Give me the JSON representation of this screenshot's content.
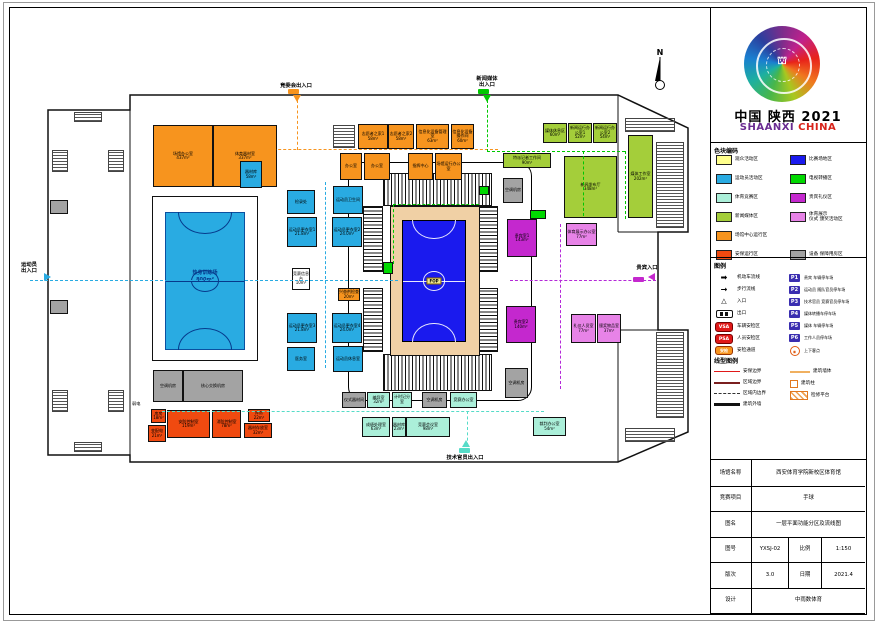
{
  "logo": {
    "cn": "中国 陕西 2021",
    "en1": "SHAANXI",
    "en2": "CHINA"
  },
  "north_label": "N",
  "palette": {
    "op": "#F7941E",
    "sec": "#F04A10",
    "ath": "#29ABE2",
    "comp": "#ABEFD9",
    "media": "#A4CE3A",
    "tv": "#00D800",
    "vip": "#C428CE",
    "cer": "#E783E7",
    "equip": "#A3A3A3",
    "fop": "#1A1AEE",
    "apron": "#F0D0A5",
    "white": "#FFFFFF"
  },
  "color_legend": {
    "title": "色块编码",
    "left": [
      {
        "label": "观众活动区",
        "color": "#FFFF8C"
      },
      {
        "label": "运动员活动区",
        "color": "#29ABE2"
      },
      {
        "label": "体育竞赛区",
        "color": "#ABEFD9"
      },
      {
        "label": "新闻媒体区",
        "color": "#A4CE3A"
      },
      {
        "label": "场馆中心运行区",
        "color": "#F7941E"
      },
      {
        "label": "安保运行区",
        "color": "#F04A10"
      }
    ],
    "right": [
      {
        "label": "比赛场地区",
        "color": "#1A1AEE"
      },
      {
        "label": "电视转播区",
        "color": "#00D800"
      },
      {
        "label": "贵宾礼仪区",
        "color": "#C428CE"
      },
      {
        "label": "体育展示\n仪式 颁奖活动区",
        "color": "#E783E7"
      },
      {
        "label": "设备 保障用房区",
        "color": "#A3A3A3"
      }
    ]
  },
  "symbol_legend": {
    "title": "图例",
    "left": [
      {
        "icon": "arrow-thick",
        "label": "机动车流线"
      },
      {
        "icon": "arrow-thin",
        "label": "步行流线"
      },
      {
        "icon": "triangle",
        "label": "入口"
      },
      {
        "icon": "exit",
        "label": "出口"
      },
      {
        "icon": "badge-VSA",
        "label": "车辆安检区"
      },
      {
        "icon": "badge-PSA",
        "label": "人员安检区"
      },
      {
        "icon": "pill",
        "pill_text": "安检",
        "label": "安检通道"
      }
    ],
    "right": [
      {
        "icon": "P1",
        "label": "贵宾 车辆停车场"
      },
      {
        "icon": "P2",
        "label": "运动员 随队官员停车场"
      },
      {
        "icon": "P3",
        "label": "技术官员 竞赛官员停车场"
      },
      {
        "icon": "P4",
        "label": "媒体转播车停车场"
      },
      {
        "icon": "P5",
        "label": "媒体 车辆停车场"
      },
      {
        "icon": "P6",
        "label": "工作人员停车场"
      },
      {
        "icon": "circle",
        "label": "上下客点"
      }
    ]
  },
  "line_legend": {
    "title": "线型图例",
    "left": [
      {
        "style": "1.5px solid #e01818",
        "label": "安保边界"
      },
      {
        "style": "2px solid #7a1f1f",
        "label": "区域边界"
      },
      {
        "style": "1.5px dashed #333",
        "label": "区域内边界"
      },
      {
        "style": "3px solid #111",
        "label": "建筑外墙"
      }
    ],
    "right": [
      {
        "style": "2px solid #f0b060",
        "label": "建筑墙体"
      },
      {
        "style": "square",
        "label": "建筑柱"
      },
      {
        "style": "hatch",
        "label": "检修平台"
      }
    ]
  },
  "title_block": {
    "rows": [
      {
        "cells": [
          {
            "t": "场馆名称",
            "w": 42,
            "label": true
          },
          {
            "t": "西安体育学院新校区体育馆",
            "w": 113
          }
        ]
      },
      {
        "cells": [
          {
            "t": "竞赛项目",
            "w": 42,
            "label": true
          },
          {
            "t": "手球",
            "w": 113
          }
        ]
      },
      {
        "cells": [
          {
            "t": "图名",
            "w": 42,
            "label": true
          },
          {
            "t": "一层平面功能分区及流线图",
            "w": 113
          }
        ]
      },
      {
        "cells": [
          {
            "t": "图号",
            "w": 42,
            "label": true
          },
          {
            "t": "YXSJ-02",
            "w": 37
          },
          {
            "t": "比例",
            "w": 33,
            "label": true
          },
          {
            "t": "1:150",
            "w": 43
          }
        ]
      },
      {
        "cells": [
          {
            "t": "版次",
            "w": 42,
            "label": true
          },
          {
            "t": "3.0",
            "w": 37
          },
          {
            "t": "日期",
            "w": 33,
            "label": true
          },
          {
            "t": "2021.4",
            "w": 43
          }
        ]
      },
      {
        "cells": [
          {
            "t": "设计",
            "w": 42,
            "label": true
          },
          {
            "t": "中雨数体育",
            "w": 113
          }
        ]
      }
    ]
  },
  "plan": {
    "courts": {
      "training": {
        "room": [
          152,
          196,
          104,
          163
        ],
        "court": [
          165,
          212,
          78,
          136
        ],
        "t": "热身训练场",
        "a": "800m²"
      },
      "fop": {
        "apron": [
          390,
          206,
          88,
          148
        ],
        "court": [
          402,
          220,
          62,
          120
        ],
        "t": "FOP"
      }
    },
    "bowl": [
      348,
      162,
      182,
      237
    ],
    "stands": [
      [
        383,
        173,
        109,
        33,
        "v"
      ],
      [
        383,
        354,
        109,
        37,
        "v"
      ],
      [
        363,
        206,
        20,
        66,
        "h"
      ],
      [
        363,
        288,
        20,
        64,
        "h"
      ],
      [
        478,
        206,
        20,
        66,
        "h"
      ],
      [
        478,
        288,
        20,
        64,
        "h"
      ]
    ],
    "stairs": [
      [
        52,
        150,
        16,
        22
      ],
      [
        108,
        150,
        16,
        22
      ],
      [
        52,
        390,
        16,
        22
      ],
      [
        108,
        390,
        16,
        22
      ],
      [
        74,
        112,
        28,
        10
      ],
      [
        74,
        442,
        28,
        10
      ],
      [
        333,
        125,
        22,
        23
      ],
      [
        625,
        118,
        50,
        14
      ],
      [
        656,
        142,
        28,
        86
      ],
      [
        656,
        332,
        28,
        86
      ],
      [
        625,
        428,
        50,
        14
      ]
    ],
    "rooms": [
      {
        "b": [
          153,
          125,
          60,
          62
        ],
        "c": "op",
        "t": "场馆办公室",
        "a": "437m²"
      },
      {
        "b": [
          213,
          125,
          64,
          62
        ],
        "c": "op",
        "t": "体育器材室",
        "a": "337m²"
      },
      {
        "b": [
          240,
          161,
          22,
          27
        ],
        "c": "ath",
        "t": "器材库",
        "a": "58m²"
      },
      {
        "b": [
          358,
          124,
          30,
          25
        ],
        "c": "op",
        "t": "志愿者之家1",
        "a": "58m²"
      },
      {
        "b": [
          388,
          124,
          26,
          25
        ],
        "c": "op",
        "t": "志愿者之家2",
        "a": "58m²"
      },
      {
        "b": [
          416,
          124,
          33,
          25
        ],
        "c": "op",
        "t": "信息化设备管理室",
        "a": "63m²"
      },
      {
        "b": [
          451,
          124,
          23,
          25
        ],
        "c": "op",
        "t": "信息化设备操作间",
        "a": "60m²"
      },
      {
        "b": [
          340,
          153,
          22,
          27
        ],
        "c": "op",
        "t": "办公室",
        "a": ""
      },
      {
        "b": [
          364,
          153,
          26,
          27
        ],
        "c": "op",
        "t": "办公室",
        "a": ""
      },
      {
        "b": [
          408,
          153,
          25,
          27
        ],
        "c": "op",
        "t": "指挥中心",
        "a": ""
      },
      {
        "b": [
          435,
          153,
          27,
          27
        ],
        "c": "op",
        "t": "场馆运行办公室",
        "a": ""
      },
      {
        "b": [
          543,
          123,
          24,
          20
        ],
        "c": "media",
        "t": "媒体休息区",
        "a": "60m²"
      },
      {
        "b": [
          568,
          123,
          24,
          20
        ],
        "c": "media",
        "t": "新闻运行办公室1",
        "a": "52m²"
      },
      {
        "b": [
          593,
          123,
          24,
          20
        ],
        "c": "media",
        "t": "新闻运行办公室2",
        "a": "54m²"
      },
      {
        "b": [
          503,
          153,
          48,
          15
        ],
        "c": "media",
        "t": "特派记者工作间",
        "a": "90m²"
      },
      {
        "b": [
          564,
          156,
          53,
          62
        ],
        "c": "media",
        "t": "新闻发布厅",
        "a": "348m²"
      },
      {
        "b": [
          628,
          135,
          25,
          83
        ],
        "c": "media",
        "t": "媒体工作室",
        "a": "202m²"
      },
      {
        "b": [
          503,
          178,
          20,
          25
        ],
        "c": "equip",
        "t": "空调机房",
        "a": ""
      },
      {
        "b": [
          507,
          219,
          30,
          38
        ],
        "c": "vip",
        "t": "贵宾室1",
        "a": "143m²"
      },
      {
        "b": [
          506,
          306,
          30,
          37
        ],
        "c": "vip",
        "t": "贵宾室2",
        "a": "140m²"
      },
      {
        "b": [
          566,
          223,
          31,
          23
        ],
        "c": "cer",
        "t": "体育展示办公室",
        "a": "77m²"
      },
      {
        "b": [
          571,
          314,
          25,
          29
        ],
        "c": "cer",
        "t": "礼仪人员室",
        "a": "77m²"
      },
      {
        "b": [
          597,
          314,
          24,
          29
        ],
        "c": "cer",
        "t": "颁奖物品室",
        "a": "37m²"
      },
      {
        "b": [
          505,
          368,
          23,
          30
        ],
        "c": "equip",
        "t": "空调机房",
        "a": ""
      },
      {
        "b": [
          287,
          217,
          30,
          30
        ],
        "c": "ath",
        "t": "运动员更衣室1",
        "a": "21.8m²"
      },
      {
        "b": [
          332,
          217,
          30,
          30
        ],
        "c": "ath",
        "t": "运动员更衣室2",
        "a": "24.0m²"
      },
      {
        "b": [
          287,
          313,
          30,
          30
        ],
        "c": "ath",
        "t": "运动员更衣室3",
        "a": "21.8m²"
      },
      {
        "b": [
          332,
          313,
          30,
          30
        ],
        "c": "ath",
        "t": "运动员更衣室4",
        "a": "24.0m²"
      },
      {
        "b": [
          333,
          186,
          30,
          28
        ],
        "c": "ath",
        "t": "运动员卫生间",
        "a": ""
      },
      {
        "b": [
          333,
          346,
          30,
          26
        ],
        "c": "ath",
        "t": "运动员休息室",
        "a": ""
      },
      {
        "b": [
          287,
          190,
          28,
          24
        ],
        "c": "ath",
        "t": "检录处",
        "a": ""
      },
      {
        "b": [
          287,
          347,
          28,
          24
        ],
        "c": "ath",
        "t": "医务室",
        "a": ""
      },
      {
        "b": [
          338,
          288,
          22,
          13
        ],
        "c": "op",
        "t": "兴奋剂检查",
        "a": "20m²"
      },
      {
        "b": [
          292,
          268,
          18,
          22
        ],
        "c": "white",
        "t": "竞赛信息台",
        "a": "10m²"
      },
      {
        "b": [
          342,
          392,
          24,
          16
        ],
        "c": "equip",
        "t": "仪式器材间",
        "a": ""
      },
      {
        "b": [
          367,
          392,
          23,
          16
        ],
        "c": "comp",
        "t": "编导室",
        "a": "32m²"
      },
      {
        "b": [
          392,
          392,
          20,
          16
        ],
        "c": "comp",
        "t": "计时记分室",
        "a": ""
      },
      {
        "b": [
          422,
          392,
          25,
          16
        ],
        "c": "equip",
        "t": "空调机房",
        "a": ""
      },
      {
        "b": [
          450,
          392,
          27,
          16
        ],
        "c": "comp",
        "t": "竞赛办公室",
        "a": ""
      },
      {
        "b": [
          362,
          417,
          28,
          20
        ],
        "c": "comp",
        "t": "成绩处理室",
        "a": "63m²"
      },
      {
        "b": [
          392,
          417,
          14,
          20
        ],
        "c": "comp",
        "t": "器材库",
        "a": "23m²"
      },
      {
        "b": [
          406,
          417,
          44,
          20
        ],
        "c": "comp",
        "t": "竞赛会议室",
        "a": "98m²"
      },
      {
        "b": [
          533,
          417,
          33,
          19
        ],
        "c": "comp",
        "t": "裁判办公室",
        "a": "54m²"
      },
      {
        "b": [
          153,
          370,
          30,
          32
        ],
        "c": "equip",
        "t": "空调机房",
        "a": ""
      },
      {
        "b": [
          183,
          370,
          60,
          32
        ],
        "c": "equip",
        "t": "核心交换机房",
        "a": ""
      },
      {
        "b": [
          167,
          410,
          43,
          28
        ],
        "c": "sec",
        "t": "安防控制室",
        "a": "119m²"
      },
      {
        "b": [
          212,
          410,
          29,
          28
        ],
        "c": "sec",
        "t": "消防控制室",
        "a": "78m²"
      },
      {
        "b": [
          248,
          409,
          22,
          13
        ],
        "c": "sec",
        "t": "库房",
        "a": "22m²"
      },
      {
        "b": [
          244,
          423,
          28,
          15
        ],
        "c": "sec",
        "t": "器材存放室",
        "a": "32m²"
      },
      {
        "b": [
          151,
          409,
          15,
          14
        ],
        "c": "sec",
        "t": "库房",
        "a": "18m²"
      },
      {
        "b": [
          148,
          425,
          18,
          17
        ],
        "c": "sec",
        "t": "变配电",
        "a": "21m²"
      },
      {
        "b": [
          50,
          200,
          18,
          14
        ],
        "c": "equip",
        "t": "",
        "a": ""
      },
      {
        "b": [
          50,
          300,
          18,
          14
        ],
        "c": "equip",
        "t": "",
        "a": ""
      },
      {
        "b": [
          383,
          262,
          10,
          12
        ],
        "c": "tv",
        "t": "",
        "a": ""
      },
      {
        "b": [
          530,
          210,
          16,
          9
        ],
        "c": "tv",
        "t": "",
        "a": ""
      },
      {
        "b": [
          479,
          186,
          10,
          9
        ],
        "c": "tv",
        "t": "",
        "a": ""
      }
    ],
    "flows": [
      {
        "o": "h",
        "x": 30,
        "y": 280,
        "l": 368,
        "c": "#29ABE2"
      },
      {
        "o": "v",
        "x": 325,
        "y": 182,
        "l": 186,
        "c": "#29ABE2"
      },
      {
        "o": "v",
        "x": 297,
        "y": 100,
        "l": 50,
        "c": "#F7941E"
      },
      {
        "o": "h",
        "x": 258,
        "y": 149,
        "l": 240,
        "c": "#F7941E"
      },
      {
        "o": "v",
        "x": 487,
        "y": 100,
        "l": 52,
        "c": "#00C800"
      },
      {
        "o": "h",
        "x": 487,
        "y": 151,
        "l": 138,
        "c": "#00C800"
      },
      {
        "o": "v",
        "x": 583,
        "y": 151,
        "l": 65,
        "c": "#00C800"
      },
      {
        "o": "v",
        "x": 625,
        "y": 151,
        "l": 68,
        "c": "#00C800"
      },
      {
        "o": "h",
        "x": 393,
        "y": 204,
        "l": 86,
        "c": "#00C800"
      },
      {
        "o": "v",
        "x": 393,
        "y": 204,
        "l": 60,
        "c": "#00C800"
      },
      {
        "o": "h",
        "x": 510,
        "y": 280,
        "l": 146,
        "c": "#B428D8"
      },
      {
        "o": "v",
        "x": 560,
        "y": 224,
        "l": 165,
        "c": "#B428D8"
      },
      {
        "o": "h",
        "x": 162,
        "y": 411,
        "l": 382,
        "c": "#55DCC8"
      },
      {
        "o": "v",
        "x": 467,
        "y": 411,
        "l": 35,
        "c": "#55DCC8"
      }
    ],
    "entrances": [
      {
        "t": "竞委会出入口",
        "c": "#F7941E",
        "tri": [
          293,
          95,
          "down"
        ],
        "label": [
          266,
          83,
          60
        ],
        "pill": [
          288,
          89,
          11,
          5
        ]
      },
      {
        "t": "新闻媒体\n出入口",
        "c": "#00C800",
        "tri": [
          483,
          95,
          "down"
        ],
        "label": [
          462,
          76,
          50
        ],
        "pill": [
          478,
          89,
          11,
          5
        ]
      },
      {
        "t": "运动员\n出入口",
        "c": "#29ABE2",
        "tri": [
          44,
          273,
          "right"
        ],
        "label": [
          12,
          262,
          34
        ],
        "pill": null
      },
      {
        "t": "贵宾入口",
        "c": "#C428CE",
        "tri": [
          648,
          273,
          "left"
        ],
        "label": [
          628,
          265,
          38
        ],
        "pill": [
          633,
          277,
          11,
          5
        ]
      },
      {
        "t": "技术官员出入口",
        "c": "#55DCC8",
        "tri": [
          462,
          440,
          "up"
        ],
        "label": [
          430,
          455,
          70
        ],
        "pill": [
          459,
          448,
          11,
          5
        ]
      }
    ],
    "float_labels": [
      {
        "t": "弱电",
        "x": 132,
        "y": 401
      }
    ]
  }
}
